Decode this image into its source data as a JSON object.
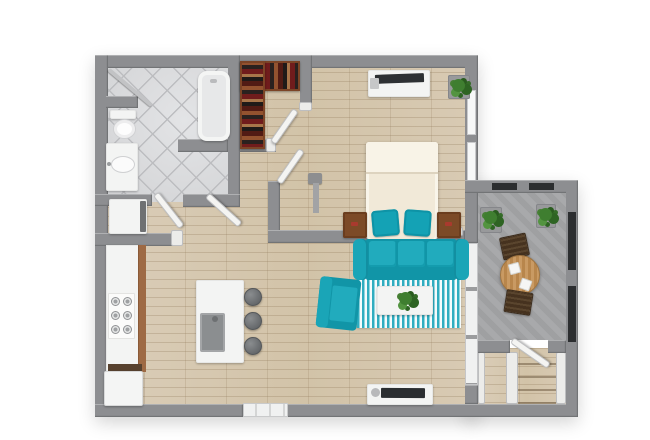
{
  "scene": {
    "title": "Apartment 3D Floor Plan - Top View",
    "type": "3d-floorplan-render",
    "background": "#ffffff"
  },
  "palette": {
    "wall_gray": "#8d8e91",
    "wood_floor": "#d6c8b0",
    "tile_floor": "#dcdddf",
    "concrete": "#a5a6a8",
    "teal_accent": "#18a1b3",
    "rug_stripe_teal": "#2fadc0",
    "shelf_wood": "#93522f",
    "nightstand_wood": "#7c4a27",
    "outdoor_wood": "#c99a63",
    "chair_dark_wood": "#4a3626",
    "plant_green": "#3f7e30",
    "fixture_white": "#f3f4f3",
    "tv_black": "#2b2e31",
    "railing_black": "#2c2e30"
  },
  "rooms": {
    "bathroom": {
      "label": "Bathroom"
    },
    "laundry": {
      "label": "Laundry Closet"
    },
    "closet": {
      "label": "Walk-in Closet"
    },
    "bedroom": {
      "label": "Bedroom"
    },
    "kitchen": {
      "label": "Kitchen"
    },
    "living": {
      "label": "Living Room"
    },
    "balcony": {
      "label": "Balcony"
    },
    "stairs": {
      "label": "Entry Stairs"
    }
  },
  "furniture": {
    "bathtub": {
      "label": "Bathtub"
    },
    "shower": {
      "label": "Shower Rod"
    },
    "toilet": {
      "label": "Toilet"
    },
    "vanity": {
      "label": "Vanity Sink"
    },
    "washer": {
      "label": "Stacked Washer Dryer"
    },
    "wardrobe": {
      "label": "Closet Shelving with Clothes"
    },
    "bed": {
      "label": "Bed with Teal Pillows"
    },
    "nightstand_left": {
      "label": "Left Nightstand"
    },
    "nightstand_right": {
      "label": "Right Nightstand"
    },
    "dresser_tv": {
      "label": "Dresser with TV"
    },
    "floor_lamp": {
      "label": "Floor Lamp"
    },
    "bedroom_plant": {
      "label": "Potted Plant"
    },
    "sofa": {
      "label": "Teal Sofa"
    },
    "armchair": {
      "label": "Teal Armchair"
    },
    "rug": {
      "label": "Teal Striped Area Rug"
    },
    "coffee_table": {
      "label": "Coffee Table with Plant"
    },
    "tv_console": {
      "label": "TV Console"
    },
    "counter": {
      "label": "Kitchen Counter"
    },
    "stove": {
      "label": "Gas Cooktop"
    },
    "fridge": {
      "label": "Refrigerator"
    },
    "island": {
      "label": "Kitchen Island with Sink"
    },
    "stools": {
      "label": "Bar Stools"
    },
    "bistro_table": {
      "label": "Outdoor Bistro Table"
    },
    "balcony_chair_top": {
      "label": "Outdoor Chair"
    },
    "balcony_chair_bottom": {
      "label": "Outdoor Chair"
    },
    "balcony_plants": {
      "label": "Balcony Planters"
    },
    "entry_door": {
      "label": "Entry Door"
    },
    "sliding_door": {
      "label": "Sliding Glass Door"
    },
    "railing": {
      "label": "Balcony Railing"
    }
  }
}
